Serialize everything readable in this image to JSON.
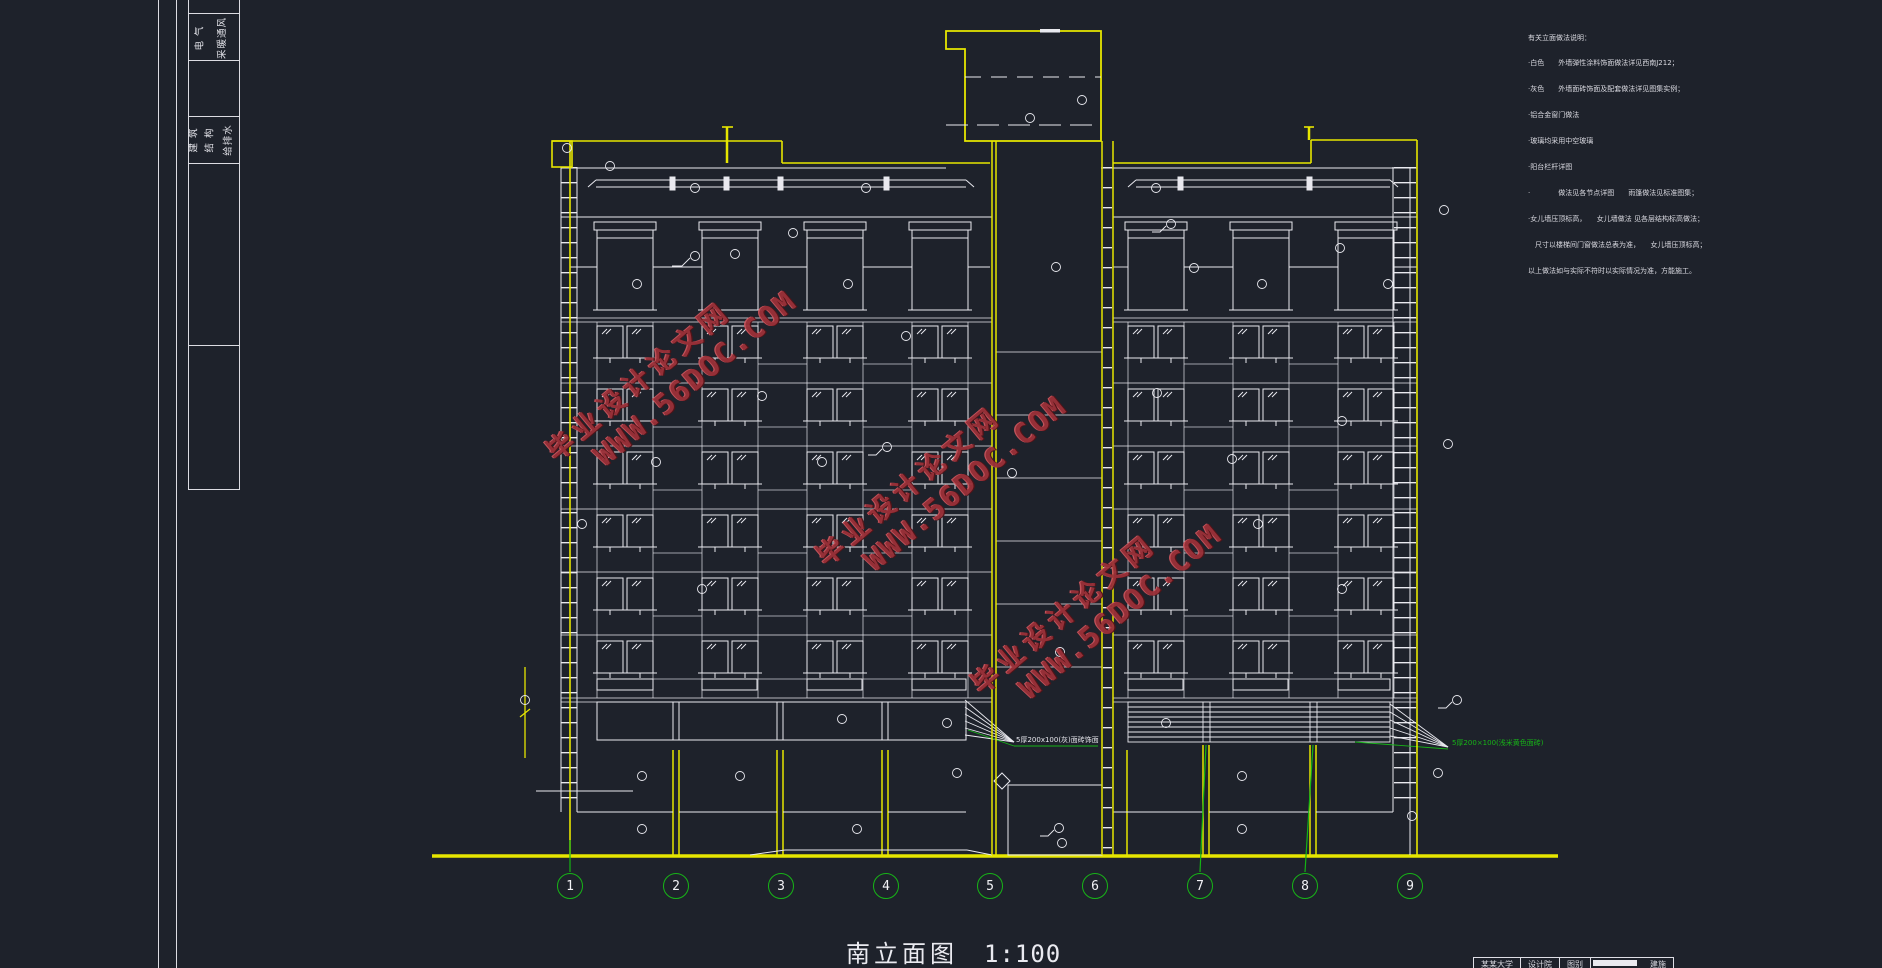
{
  "drawing": {
    "title": "南立面图",
    "scale": "1:100",
    "axis_labels": [
      "1",
      "2",
      "3",
      "4",
      "5",
      "6",
      "7",
      "8",
      "9"
    ],
    "watermark": {
      "line1": "毕业设计论文网",
      "line2": "WWW.56DOC.COM"
    },
    "notes": {
      "title": "有关立面做法说明：",
      "lines": [
        "·白色　　外墙弹性涂料饰面做法详见西南J212；",
        "·灰色　　外墙面砖饰面及配套做法详见图集实例；",
        "·铝合金窗门做法",
        "·玻璃均采用中空玻璃",
        "·阳台栏杆详图",
        "·　　　　做法见各节点详图　　雨篷做法见标准图集；",
        "·女儿墙压顶标高，　　女儿墙做法 见各层结构标高做法；",
        "　尺寸以楼梯间门窗做法总表为准，　　女儿墙压顶标高；",
        "以上做法如与实际不符时以实际情况为准，方能施工。"
      ]
    },
    "annotations": {
      "facade_tile_left": "5厚200x100(灰)面砖饰面",
      "facade_tile_right": "5厚200×100(浅米黄色面砖)"
    },
    "left_titleblock": {
      "group1": [
        "电 气",
        "采暖通风"
      ],
      "group2": [
        "建 筑",
        "结 构",
        "给排水"
      ]
    },
    "bottom_titleblock": {
      "cells": [
        "某某大学",
        "设计院",
        "图别",
        "建施"
      ]
    },
    "colors": {
      "background": "#1e222b",
      "line_yellow": "#e6e600",
      "line_white": "#e9e9ef",
      "axis_green": "#14b414",
      "watermark_red": "#9c3038",
      "annotation_green": "#12b412"
    }
  }
}
